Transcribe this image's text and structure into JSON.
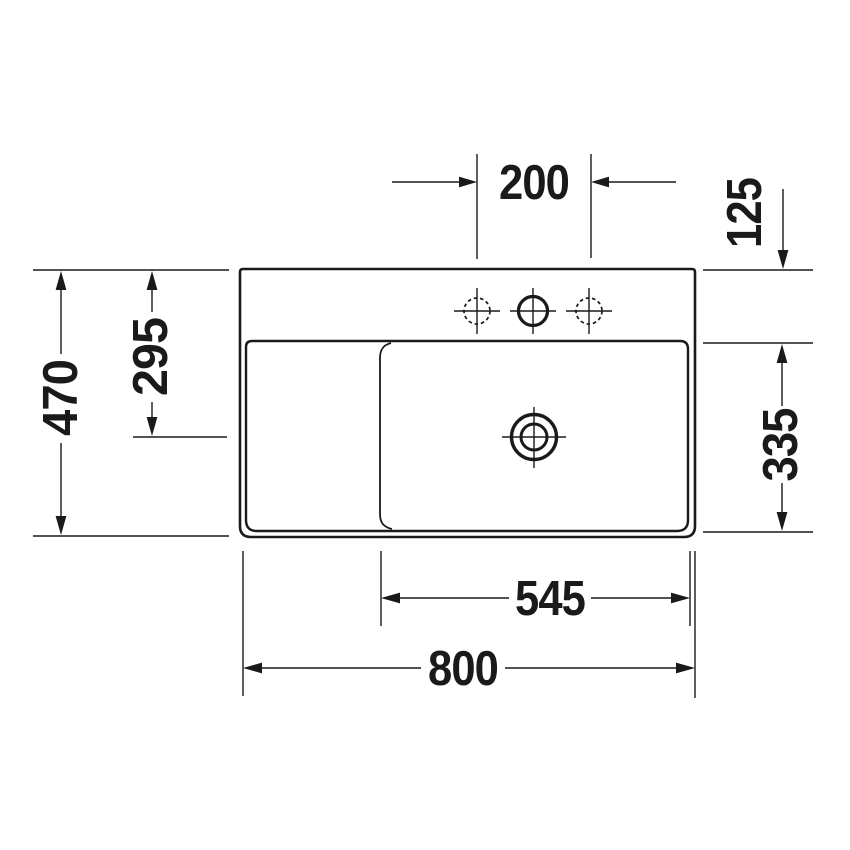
{
  "colors": {
    "ink": "#1a1a1a",
    "paper": "#ffffff"
  },
  "drawing": {
    "subject": "washbasin-top-view-technical-drawing",
    "units": "mm"
  },
  "dimensions": {
    "faucet_hole_spacing": "200",
    "faucet_setback": "125",
    "overall_depth": "470",
    "drain_setback": "295",
    "basin_depth": "335",
    "basin_width": "545",
    "overall_width": "800"
  }
}
